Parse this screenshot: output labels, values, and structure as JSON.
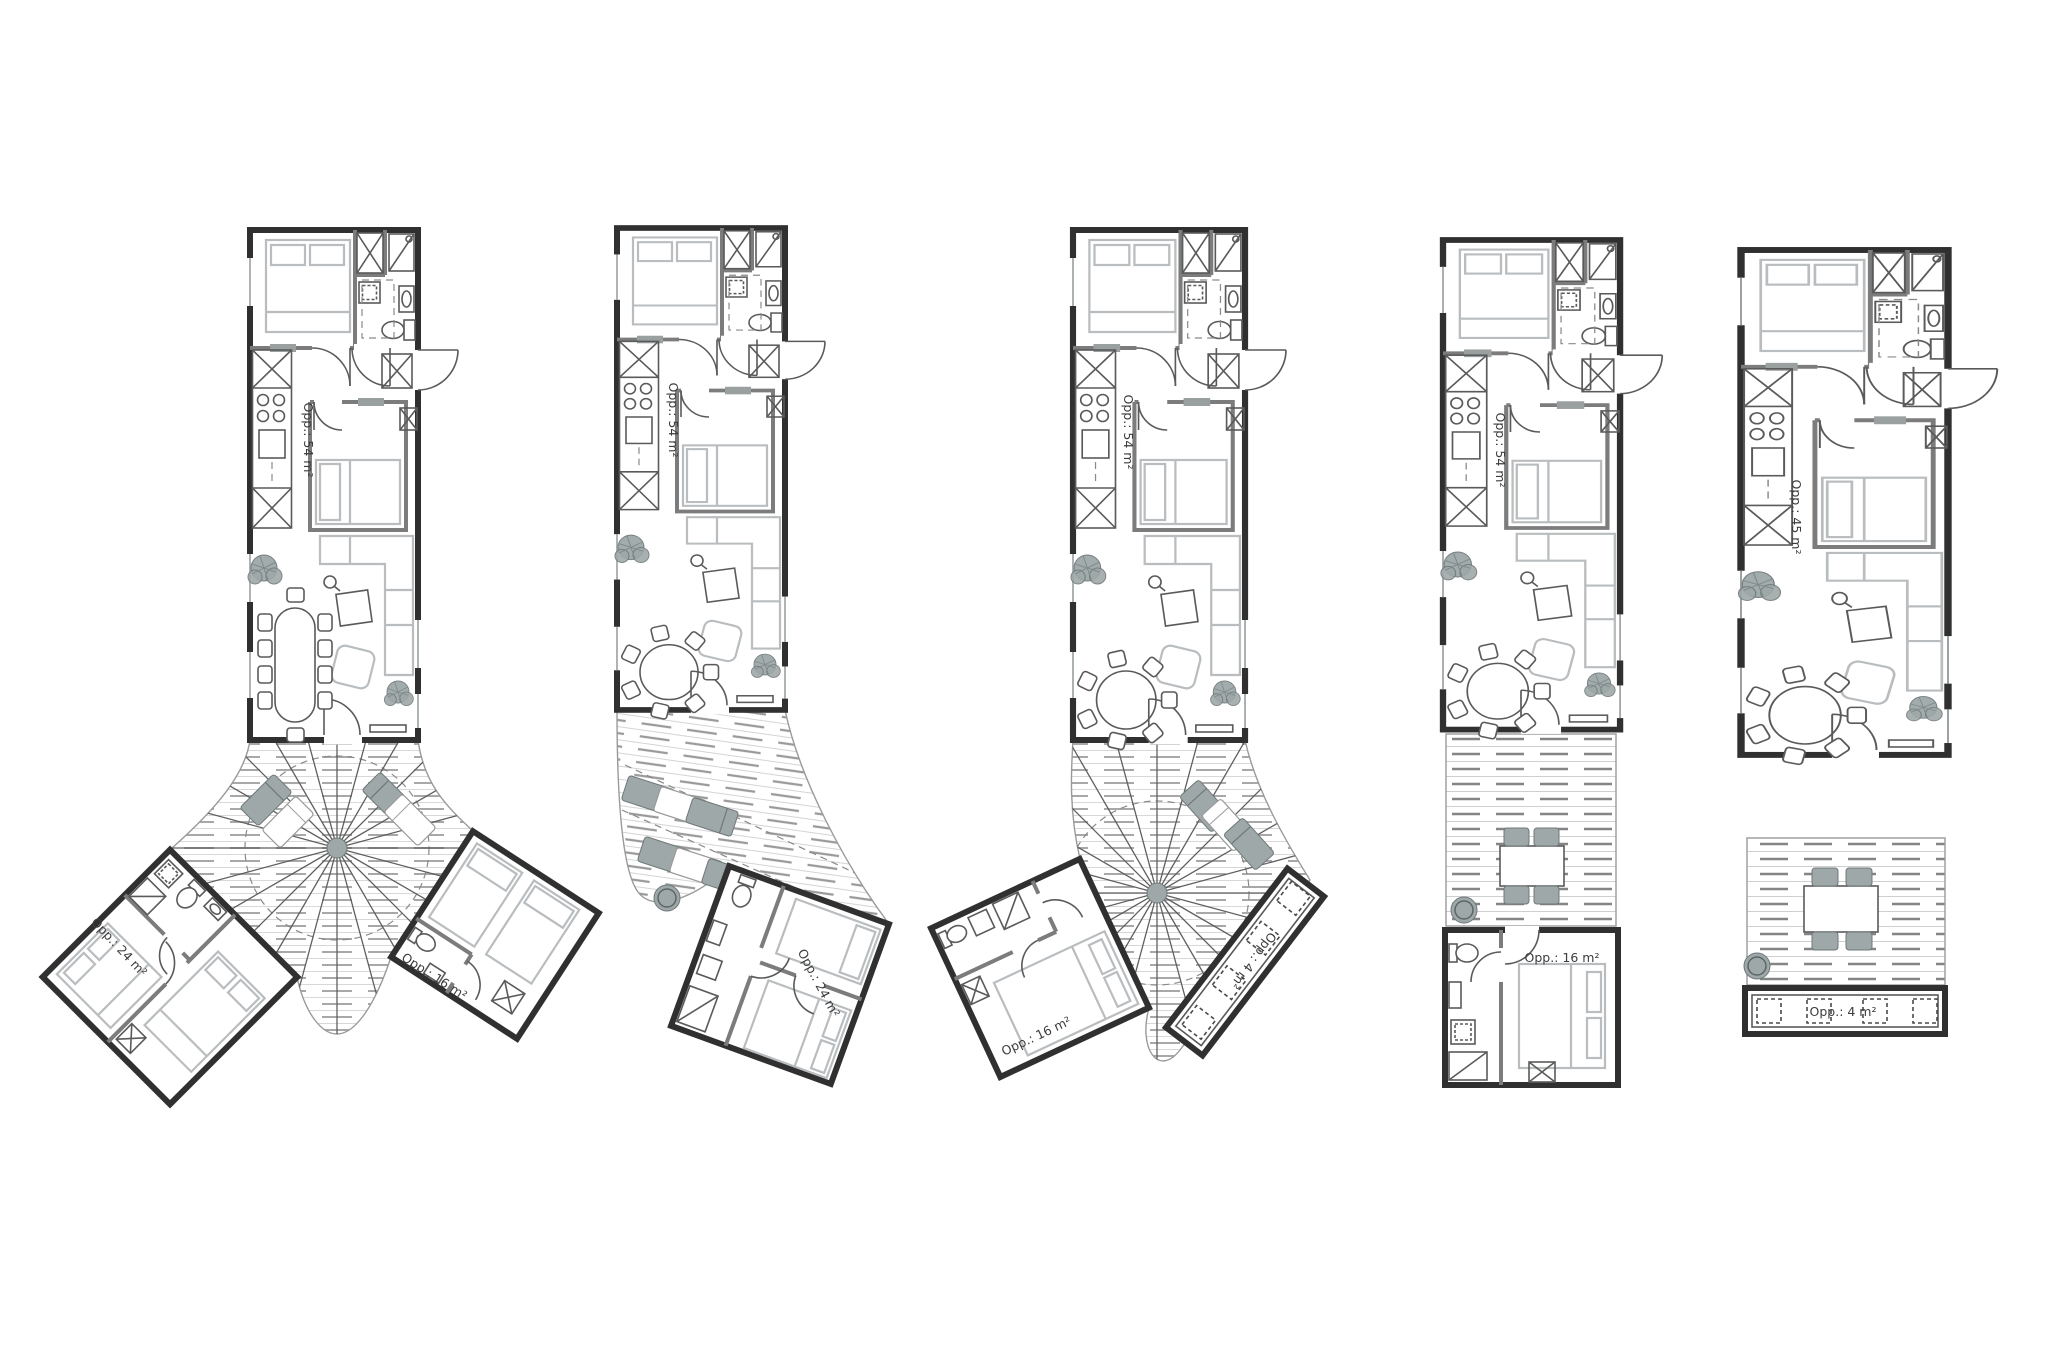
{
  "sheet": {
    "description": "Five cabin floor plan variants, plan drawings with decks and annex wings",
    "background": "#ffffff"
  },
  "colors": {
    "wall": "#303030",
    "partition": "#7c7c7c",
    "fixture": "#5a5a5a",
    "furniture": "#b9bdbf",
    "soft_gray": "#9fa8a8",
    "deck_line": "#8d8d8d",
    "label_text": "#3c3c3c",
    "background": "#ffffff"
  },
  "plans": [
    {
      "id": 1,
      "name": "y-plan-two-wings-radial-deck",
      "main": "Opp.: 54 m²",
      "wing_left": "Opp.: 24 m²",
      "wing_right": "Opp.: 16 m²"
    },
    {
      "id": 2,
      "name": "plan-one-wing-plank-deck",
      "main": "Opp.: 54 m²",
      "wing": "Opp.: 24 m²"
    },
    {
      "id": 3,
      "name": "plan-one-wing-radial-deck-storage",
      "main": "Opp.: 54 m²",
      "wing": "Opp.: 16 m²",
      "storage": "Opp.: 4 m²"
    },
    {
      "id": 4,
      "name": "linear-plan-annex",
      "main": "Opp.: 54 m²",
      "annex": "Opp.: 16 m²"
    },
    {
      "id": 5,
      "name": "linear-plan-storage",
      "main": "Opp.: 45 m²",
      "storage": "Opp.: 4 m²"
    }
  ]
}
